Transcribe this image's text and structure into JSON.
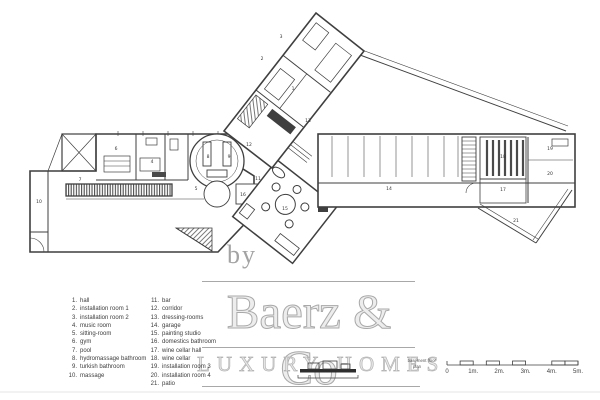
{
  "watermark": {
    "by": "by",
    "brand": "Baerz & Co",
    "tagline": "LUXURY HOMES"
  },
  "legend": {
    "columns": [
      {
        "items": [
          {
            "num": "1.",
            "label": "hall"
          },
          {
            "num": "2.",
            "label": "installation room 1"
          },
          {
            "num": "3.",
            "label": "installation room 2"
          },
          {
            "num": "4.",
            "label": "music room"
          },
          {
            "num": "5.",
            "label": "sitting-room"
          },
          {
            "num": "6.",
            "label": "gym"
          },
          {
            "num": "7.",
            "label": "pool"
          },
          {
            "num": "8.",
            "label": "hydromassage bathroom"
          },
          {
            "num": "9.",
            "label": "turkish bathroom"
          },
          {
            "num": "10.",
            "label": "massage"
          }
        ]
      },
      {
        "items": [
          {
            "num": "11.",
            "label": "bar"
          },
          {
            "num": "12.",
            "label": "corridor"
          },
          {
            "num": "13.",
            "label": "dressing-rooms"
          },
          {
            "num": "14.",
            "label": "garage"
          },
          {
            "num": "15.",
            "label": "painting studio"
          },
          {
            "num": "16.",
            "label": "domestics bathroom"
          },
          {
            "num": "17.",
            "label": "wine cellar hall"
          },
          {
            "num": "18.",
            "label": "wine cellar"
          },
          {
            "num": "19.",
            "label": "installation room 3"
          },
          {
            "num": "20.",
            "label": "installation room 4"
          },
          {
            "num": "21.",
            "label": "patio"
          }
        ]
      }
    ]
  },
  "plan": {
    "caption_line1": "basement floor",
    "caption_line2": "plan",
    "room_labels": [
      {
        "n": "1",
        "x": 293,
        "y": 90
      },
      {
        "n": "2",
        "x": 262,
        "y": 60
      },
      {
        "n": "3",
        "x": 281,
        "y": 38
      },
      {
        "n": "4",
        "x": 152,
        "y": 163
      },
      {
        "n": "5",
        "x": 196,
        "y": 190
      },
      {
        "n": "6",
        "x": 116,
        "y": 150
      },
      {
        "n": "7",
        "x": 80,
        "y": 181
      },
      {
        "n": "8",
        "x": 208,
        "y": 158
      },
      {
        "n": "9",
        "x": 229,
        "y": 158
      },
      {
        "n": "10",
        "x": 39,
        "y": 203
      },
      {
        "n": "11",
        "x": 258,
        "y": 180
      },
      {
        "n": "12",
        "x": 249,
        "y": 146
      },
      {
        "n": "13",
        "x": 308,
        "y": 122
      },
      {
        "n": "14",
        "x": 389,
        "y": 190
      },
      {
        "n": "15",
        "x": 285,
        "y": 210
      },
      {
        "n": "16",
        "x": 243,
        "y": 196
      },
      {
        "n": "17",
        "x": 503,
        "y": 191
      },
      {
        "n": "18",
        "x": 503,
        "y": 158
      },
      {
        "n": "19",
        "x": 550,
        "y": 150
      },
      {
        "n": "20",
        "x": 550,
        "y": 175
      },
      {
        "n": "21",
        "x": 516,
        "y": 222
      }
    ]
  },
  "scale_bar": {
    "labels": [
      "0",
      "1m.",
      "2m.",
      "3m.",
      "4m.",
      "5m."
    ]
  },
  "colors": {
    "line": "#3f3f3f",
    "watermark": "#c9c9c9",
    "rule": "#a8a8a8"
  }
}
